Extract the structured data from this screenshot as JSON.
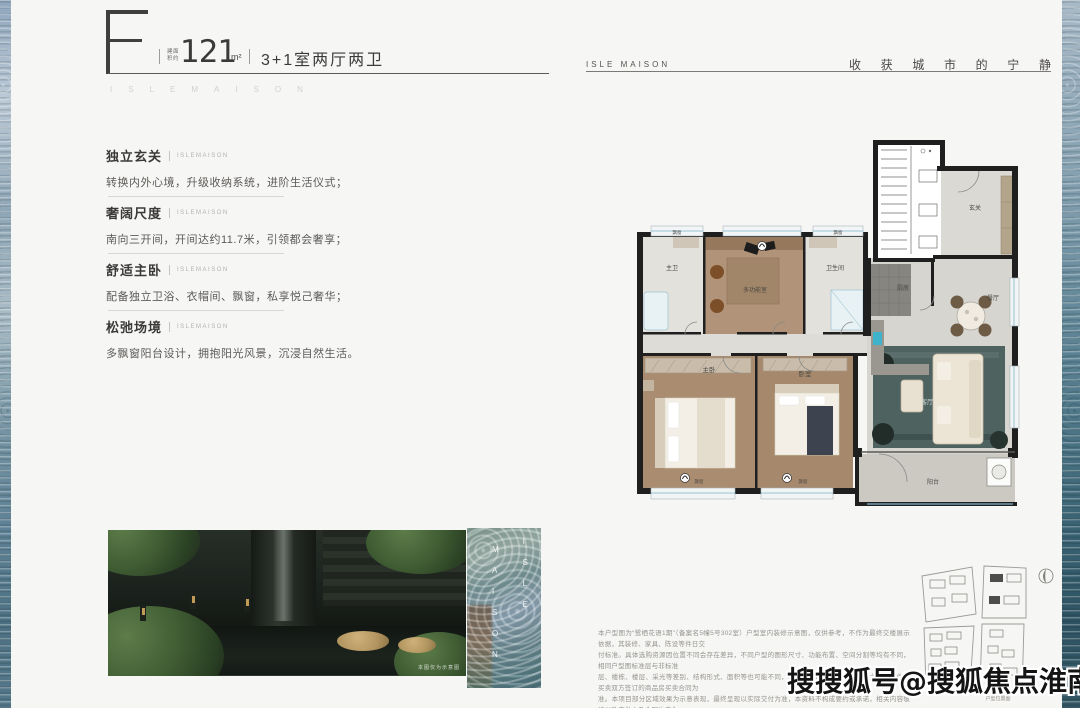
{
  "header": {
    "type_letter": "F",
    "area_label_line1": "建面",
    "area_label_line2": "积约",
    "area_value": "121",
    "area_unit": "m²",
    "layout": "3+1室两厅两卫",
    "brand_spaced": "ISLEMAISON"
  },
  "topbar_right": {
    "brand": "ISLE MAISON",
    "slogan_chars": [
      "收",
      "获",
      "城",
      "市",
      "的",
      "宁",
      "静"
    ]
  },
  "features": [
    {
      "title": "独立玄关",
      "tag": "ISLEMAISON",
      "desc": "转换内外心境，升级收纳系统，进阶生活仪式；"
    },
    {
      "title": "奢阔尺度",
      "tag": "ISLEMAISON",
      "desc": "南向三开间，开间达约11.7米，引领都会奢享；"
    },
    {
      "title": "舒适主卧",
      "tag": "ISLEMAISON",
      "desc": "配备独立卫浴、衣帽间、飘窗，私享悦己奢华；"
    },
    {
      "title": "松弛场境",
      "tag": "ISLEMAISON",
      "desc": "多飘窗阳台设计，拥抱阳光风景，沉浸自然生活。"
    }
  ],
  "photo": {
    "caption": "本图仅为示意图"
  },
  "glass_panel": {
    "col_right": "ISLE",
    "col_left": "MAISON"
  },
  "floorplan": {
    "rooms": [
      {
        "label": "玄关",
        "x": 348,
        "y": 70,
        "size": 6
      },
      {
        "label": "主卫",
        "x": 45,
        "y": 130,
        "size": 6
      },
      {
        "label": "多功能室",
        "x": 128,
        "y": 152,
        "size": 6
      },
      {
        "label": "卫生间",
        "x": 208,
        "y": 130,
        "size": 6
      },
      {
        "label": "厨房",
        "x": 276,
        "y": 150,
        "size": 6
      },
      {
        "label": "餐厅",
        "x": 366,
        "y": 160,
        "size": 6
      },
      {
        "label": "主卧",
        "x": 82,
        "y": 232,
        "size": 6.5
      },
      {
        "label": "卧室",
        "x": 178,
        "y": 236,
        "size": 6.5
      },
      {
        "label": "客厅",
        "x": 300,
        "y": 264,
        "size": 6.5,
        "fill": "#d3d7d4"
      },
      {
        "label": "阳台",
        "x": 306,
        "y": 344,
        "size": 6
      },
      {
        "label": "飘窗",
        "x": 50,
        "y": 94,
        "size": 4.5
      },
      {
        "label": "飘窗",
        "x": 211,
        "y": 94,
        "size": 4.5
      },
      {
        "label": "飘窗",
        "x": 72,
        "y": 343,
        "size": 4.5
      },
      {
        "label": "飘窗",
        "x": 176,
        "y": 343,
        "size": 4.5
      }
    ]
  },
  "siteplan": {
    "caption": "户型位置图"
  },
  "disclaimer": {
    "lines": [
      "本户型图为“鹭栖花语1期”（备案名5幢5号302室）户型室内装修示意图，仅供参考，不作为最终交楼展示依据，其装修、家具、陈设等件日交",
      "付标准。具体选购资源因位置不同会存在差异，不同户型的图形尺寸、功能布置、空间分割等均有不同，相同户型图标准层与非标准",
      "层、楼栋、楼层、采光等差别、结构形式、面积等也可能不同，具体情况以项目最后经批准之法律文件和买卖双方签订的商品房买卖合同为",
      "准。本项目部分区域效果为示意表现，最终呈现以实际交付为准，本资料不构成要约或承诺，相关内容敬请以政府批文及合同约定为",
      "准。本项目推广备案名为“鹭栖花语苑”，本资料制作时间为2023年8月29日，相关变化不再另行通知。"
    ]
  },
  "watermark": "搜搜狐号@搜狐焦点淮南站"
}
